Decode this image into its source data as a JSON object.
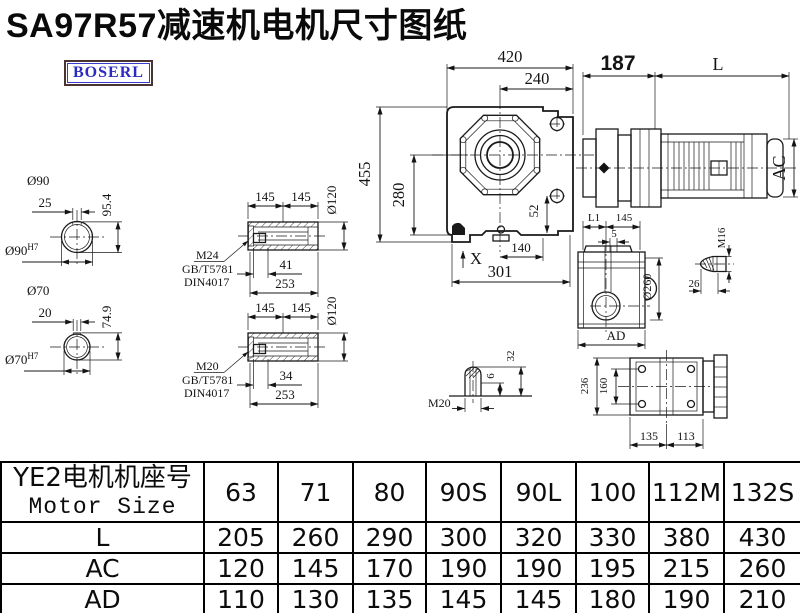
{
  "title": "SA97R57减速机电机尺寸图纸",
  "brand": "BOSERL",
  "colors": {
    "line": "#1a1a1a",
    "brand_text": "#2b2bbf",
    "brand_border": "#4a3333"
  },
  "drawing": {
    "shaft90": {
      "dia": "Ø90",
      "key_width": "25",
      "total_height": "95.4",
      "bore": "Ø90",
      "bore_fit": "H7"
    },
    "shaft70": {
      "dia": "Ø70",
      "key_width": "20",
      "total_height": "74.9",
      "bore": "Ø70",
      "bore_fit": "H7"
    },
    "hollow_m24": {
      "len1": "145",
      "len2": "145",
      "dia": "Ø120",
      "thread": "M24",
      "std_gb": "GB/T5781",
      "std_din": "DIN4017",
      "bolt_len": "41",
      "total_len": "253"
    },
    "hollow_m20": {
      "len1": "145",
      "len2": "145",
      "dia": "Ø120",
      "thread": "M20",
      "std_gb": "GB/T5781",
      "std_din": "DIN4017",
      "bolt_len": "34",
      "total_len": "253"
    },
    "front": {
      "overall_width": "420",
      "flange_width": "240",
      "overall_height": "455",
      "center_to_base": "280",
      "dim_52": "52",
      "x_label": "X",
      "dim_140": "140",
      "dim_301": "301"
    },
    "motor": {
      "adapter_len": "187",
      "motor_len_label": "L",
      "motor_dia_label": "AC"
    },
    "side": {
      "l1_label": "L1",
      "dim_145": "145",
      "dim_5": "5",
      "flange_dia": "Ø260",
      "ad_label": "AD"
    },
    "bolt_m16": {
      "thread": "M16",
      "dim_26": "26"
    },
    "bolt_m20": {
      "thread": "M20",
      "dim_6": "6",
      "dim_32": "32"
    },
    "rear": {
      "dim_236": "236",
      "dim_160": "160",
      "dim_135": "135",
      "dim_113": "113"
    }
  },
  "table": {
    "header": {
      "line1": "YE2电机机座号",
      "line2": "Motor Size"
    },
    "sizes": [
      "63",
      "71",
      "80",
      "90S",
      "90L",
      "100",
      "112M",
      "132S"
    ],
    "rows": [
      {
        "label": "L",
        "values": [
          "205",
          "260",
          "290",
          "300",
          "320",
          "330",
          "380",
          "430"
        ]
      },
      {
        "label": "AC",
        "values": [
          "120",
          "145",
          "170",
          "190",
          "190",
          "195",
          "215",
          "260"
        ]
      },
      {
        "label": "AD",
        "values": [
          "110",
          "130",
          "135",
          "145",
          "145",
          "180",
          "190",
          "210"
        ]
      }
    ]
  }
}
